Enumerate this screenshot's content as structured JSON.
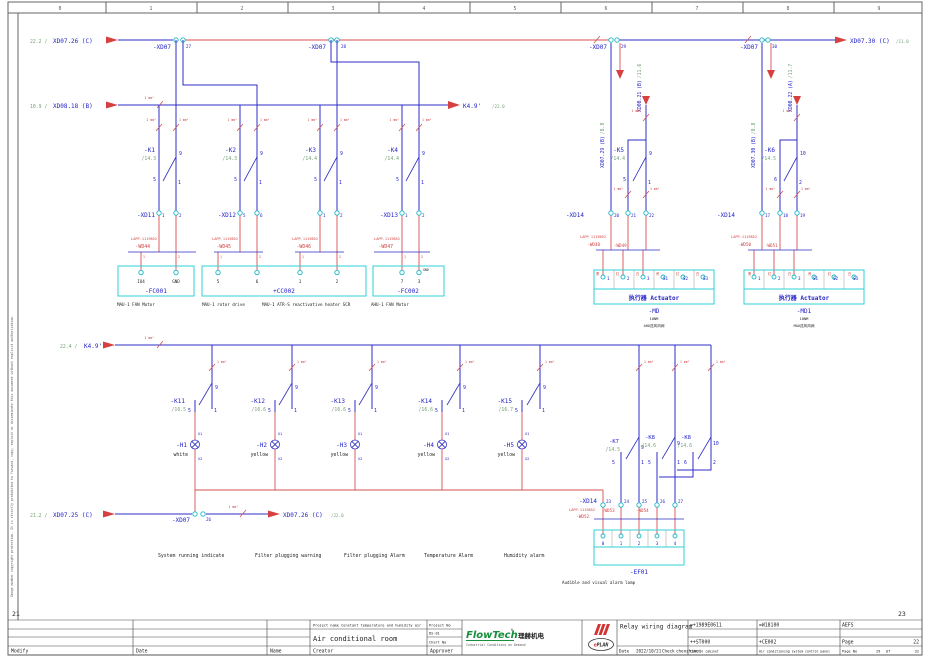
{
  "page": {
    "ruler": [
      "0",
      "1",
      "2",
      "3",
      "4",
      "5",
      "6",
      "7",
      "8",
      "9"
    ],
    "prev": "21",
    "next": "23",
    "side_note": "Image number copyright protection. It is strictly prohibited to forward, copy, exploit or disseminate this document without explicit authorization."
  },
  "cores": [
    "1",
    "2"
  ],
  "wire_note": "1 mm²",
  "pins": {
    "p9": "9",
    "p5": "5",
    "p1": "1",
    "p10": "10",
    "p6": "6",
    "p2": "2"
  },
  "top": {
    "feed1_ref": "22.2 /",
    "feed1": "XD07.26 (C)",
    "feed2_ref": "10.9 /",
    "feed2": "XD08.18 (B)",
    "exit1": "XD07.30 (C)",
    "exit1_ref": "/11.0",
    "exit2": "K4.9'",
    "exit2_ref": "/22.0",
    "xd07": "-XD07",
    "p27": "27",
    "p28": "28",
    "p29": "29",
    "p30": "30",
    "k1": "-K1",
    "k1x": "/14.3",
    "k2": "-K2",
    "k2x": "/14.3",
    "k3": "-K3",
    "k3x": "/14.4",
    "k4": "-K4",
    "k4x": "/14.4",
    "k5": "-K5",
    "k5x": "/14.4",
    "k6": "-K6",
    "k6x": "/14.5",
    "xd11": "-XD11",
    "xd11p": [
      "1",
      "2"
    ],
    "xd12": "-XD12",
    "xd12p": [
      "5",
      "6"
    ],
    "xd12bp": [
      "1",
      "2"
    ],
    "xd13": "-XD13",
    "xd13p": [
      "1",
      "2"
    ],
    "mfr": "LAPP.1119852",
    "wd44": "-WD44",
    "wd45": "-WD45",
    "wd46": "-WD46",
    "wd47": "-WD47",
    "wd48": "-WD48",
    "wd49": "-WD49",
    "wd50": "-WD50",
    "wd51": "-WD51",
    "fc001": "-FC001",
    "fc001p": [
      "IO4",
      "GND"
    ],
    "fc001c": "MAU-1 FAN Motor",
    "cc002": "+CC002",
    "cc002p": [
      "5",
      "6",
      "1",
      "2"
    ],
    "cc002c1": "MAU-1 rotor drive",
    "cc002c2": "MAU-1 ATR-S reactivative heater SCR",
    "fc002": "-FC002",
    "fc002p": [
      "7",
      "3"
    ],
    "fc002gnd": "GND",
    "fc002c": "AHU-1 FAN Motor",
    "down1": "XD07.29 (B)",
    "down1_ref": "/8.8",
    "down2": "XD07.30 (B)",
    "down2_ref": "/8.8",
    "up1": "XD08.21 (B)",
    "up1_ref": "/11.6",
    "up2": "XD08.22 (A)",
    "up2_ref": "/11.7",
    "xd14": "-XD14",
    "xd14L": [
      "20",
      "21",
      "22"
    ],
    "xd14R": [
      "17",
      "18",
      "19"
    ],
    "act_title": "执行器  Actuator",
    "act_pins": [
      "1",
      "2",
      "3",
      "S1",
      "S2",
      "S3"
    ],
    "act_marks": [
      "黑",
      "红",
      "白",
      "黄",
      "红",
      "白"
    ],
    "md": "-MD",
    "md_spec": "10NM",
    "md_c": "AHU送风风阀",
    "md1": "-MD1",
    "md1_spec": "10NM",
    "md1_c": "MAU送风风阀"
  },
  "mid": {
    "feed_ref": "22.4 /",
    "feed": "K4.9'",
    "k11": "-K11",
    "k11x": "/16.5",
    "k12": "-K12",
    "k12x": "/16.6",
    "k13": "-K13",
    "k13x": "/16.6",
    "k14": "-K14",
    "k14x": "/16.6",
    "k15": "-K15",
    "k15x": "/16.7",
    "k7": "-K7",
    "k7x": "/14.5",
    "k8": "-K8",
    "k8x": "/14.6",
    "x1": "X1",
    "x2": "X2",
    "h1": "-H1",
    "h1c": "white",
    "h2": "-H2",
    "h2c": "yellow",
    "h3": "-H3",
    "h3c": "yellow",
    "h4": "-H4",
    "h4c": "yellow",
    "h5": "-H5",
    "h5c": "yellow",
    "captions": [
      "System  running indicate",
      "Filter plugging warning",
      "Filter plugging Alarm",
      "Temperature Alarm",
      "Humidity alarm"
    ]
  },
  "bottom": {
    "feed_ref": "21.2 /",
    "feed": "XD07.25 (C)",
    "exit": "XD07.26 (C)",
    "exit_ref": "/22.0",
    "xd07": "-XD07",
    "p26": "26",
    "xd14": "-XD14",
    "xd14p": [
      "23",
      "24",
      "25",
      "26",
      "27"
    ],
    "mfr": "LAPP.1119852",
    "wd52": "-WD52",
    "wd53": "-WD53",
    "wd54": "-WD54",
    "ef01": "-EF01",
    "ef01p": [
      "0",
      "1",
      "2",
      "3",
      "4"
    ],
    "ef01c": "Audible and visual alarm lamp"
  },
  "tb": {
    "modify": "Modify",
    "date": "Date",
    "name": "Name",
    "creator": "Creator",
    "approver": "Approver",
    "project_label": "Project name  Constant temperature and humidity air",
    "project_name": "Air conditional room",
    "project_no_label": "Project No",
    "project_no": "DS-01",
    "chart_no_label": "Chart No",
    "brand": "FlowTech",
    "brand_reg": "®",
    "brand_cn": "理赫机电",
    "brand_tagline": "Industrial Conditions on Demand",
    "eplan_e": "e",
    "eplan_rest": "PLAN",
    "title": "Relay wiring diagram",
    "date_label": "Date",
    "date_value": "2022/10/21",
    "check_label": "Check",
    "check_value": "chenzhimei",
    "code1": "=+1989E0611",
    "code2": "=W18100",
    "code3": "AEFS",
    "code4": "++ST000",
    "code5": "+CE002",
    "desc1": "Control cabinet",
    "desc2": "Air conditioning system control panel",
    "page_label": "Page",
    "page_value": "22",
    "pageno_label": "Page No",
    "pageno_value": "29",
    "of": "Of",
    "total": "32"
  }
}
